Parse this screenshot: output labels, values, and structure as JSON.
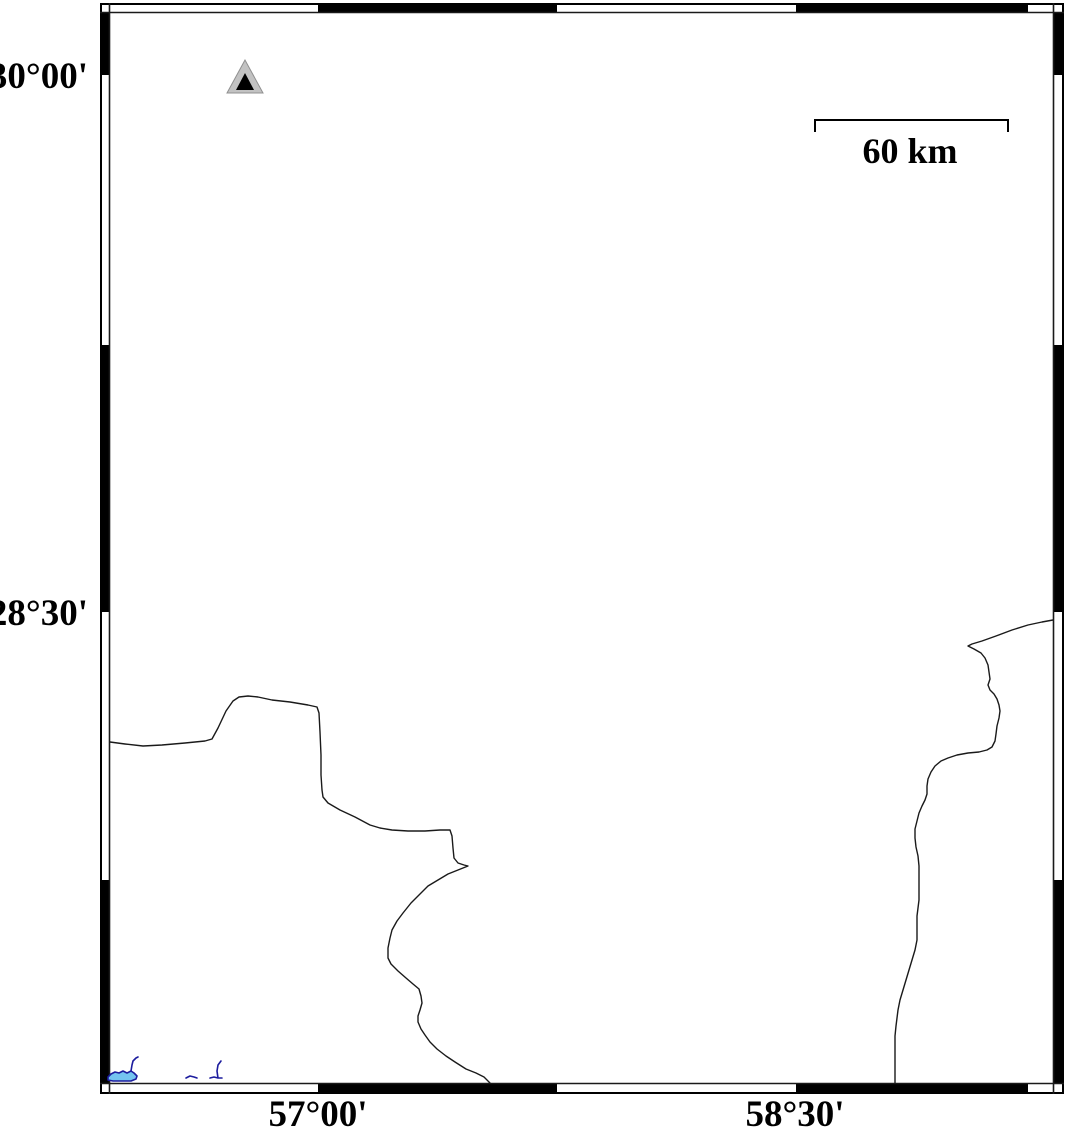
{
  "map": {
    "type": "geographic-map",
    "background_color": "#ffffff",
    "frame_color": "#000000"
  },
  "frame": {
    "lat_labels": [
      "30°00'",
      "28°30'"
    ],
    "lon_labels": [
      "57°00'",
      "58°30'"
    ],
    "top_black_segments": [
      [
        318,
        557
      ],
      [
        796,
        1028
      ]
    ],
    "bottom_black_segments": [
      [
        318,
        557
      ],
      [
        796,
        1028
      ]
    ],
    "left_black_segments": [
      [
        12,
        75
      ],
      [
        345,
        612
      ],
      [
        880,
        1084
      ]
    ],
    "right_black_segments": [
      [
        12,
        75
      ],
      [
        345,
        612
      ],
      [
        880,
        1084
      ]
    ]
  },
  "scale_bar": {
    "label": "60 km",
    "x1": 815,
    "x2": 1008,
    "y": 120,
    "tick_len": 12
  },
  "marker": {
    "kind": "triangle-station-marker",
    "outer_fill": "#c2c2c2",
    "outer_stroke": "#909090",
    "inner_fill": "#000000",
    "outer_points": "245,60 227,93 263,93",
    "inner_points": "245,73 236,90 254,90"
  },
  "geo": {
    "boundary_color": "#1a1a1a",
    "water_stroke": "#1c1c9e",
    "water_fill": "#74c4f0",
    "west_boundary": "M 110,742 L 125,744 L 143,746 L 162,745 L 185,743 L 205,741 L 212,739 L 218,728 L 226,711 L 233,701 L 239,697 L 248,696 L 258,697 L 272,700 L 290,702 L 308,705 L 317,707 L 319,713 L 320,732 L 321,755 L 321,775 L 322,790 L 323,797 L 328,803 L 340,810 L 355,817 L 370,825 L 380,828 L 392,830 L 408,831 L 425,831 L 440,830 L 450,830 L 452,836 L 453,848 L 454,858 L 458,863 L 464,865 L 468,866 L 458,870 L 448,874 L 438,880 L 428,886 L 419,895 L 411,903 L 403,913 L 397,921 L 392,930 L 390,938 L 388,948 L 388,958 L 391,964 L 398,971 L 406,978 L 413,984 L 419,989 L 421,996 L 422,1003 L 420,1010 L 418,1016 L 418,1022 L 421,1029 L 425,1035 L 430,1042 L 437,1049 L 446,1056 L 455,1062 L 466,1069 L 476,1073 L 484,1077 L 490,1083",
    "east_boundary": "M 1053,620 L 1042,622 L 1028,625 L 1012,630 L 996,636 L 982,641 L 972,644 L 968,646 L 974,649 L 981,653 L 985,658 L 988,665 L 989,672 L 990,679 L 988,685 L 990,690 L 994,694 L 997,699 L 999,705 L 1000,711 L 999,718 L 997,726 L 996,734 L 995,741 L 992,747 L 987,750 L 979,752 L 968,753 L 957,755 L 948,758 L 941,761 L 935,766 L 931,772 L 928,779 L 927,786 L 927,794 L 925,800 L 922,806 L 919,813 L 917,821 L 915,829 L 915,838 L 916,847 L 918,856 L 919,866 L 919,878 L 919,890 L 919,900 L 918,908 L 917,916 L 917,928 L 917,940 L 915,950 L 912,960 L 909,970 L 906,980 L 903,990 L 900,1000 L 898,1010 L 897,1018 L 896,1026 L 895,1036 L 895,1048 L 895,1060 L 895,1072 L 895,1083",
    "lake": "M 108,1077 L 111,1074 L 115,1072 L 119,1073 L 123,1071 L 127,1073 L 131,1071 L 134,1073 L 137,1076 L 136,1079 L 131,1081 L 122,1081 L 113,1081 L 108,1080 Z",
    "river_spike_west": "M 131,1071 L 132,1065 L 133,1061 L 136,1058 L 138,1057",
    "river_dash": "M 186,1078 L 190,1076 L 194,1077 L 197,1078",
    "river_spike_east": "M 210,1078 L 214,1077 L 218,1078 L 222,1078 M 218,1078 L 217,1071 L 218,1065 L 221,1061"
  }
}
